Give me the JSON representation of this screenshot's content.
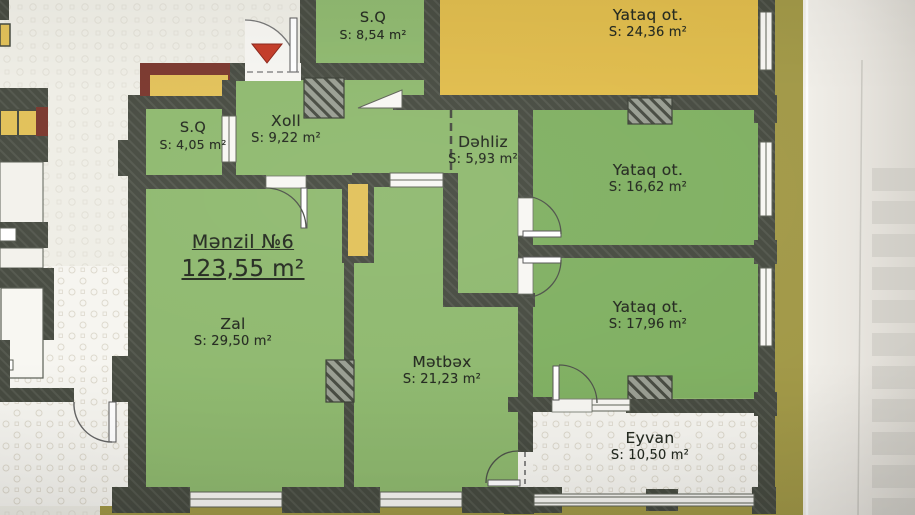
{
  "plan": {
    "apartment": {
      "label": "Mənzil №6",
      "total_area": "123,55 m²"
    },
    "rooms": {
      "sq_top": {
        "name": "S.Q",
        "area": "S: 8,54 m²"
      },
      "yataq_top": {
        "name": "Yataq ot.",
        "area": "S: 24,36 m²"
      },
      "sq_left": {
        "name": "S.Q",
        "area": "S: 4,05 m²"
      },
      "xoll": {
        "name": "Xoll",
        "area": "S: 9,22 m²"
      },
      "dehliz": {
        "name": "Dəhliz",
        "area": "S: 5,93 m²"
      },
      "yataq_mid": {
        "name": "Yataq ot.",
        "area": "S: 16,62 m²"
      },
      "zal": {
        "name": "Zal",
        "area": "S: 29,50 m²"
      },
      "metbex": {
        "name": "Mətbəx",
        "area": "S: 21,23 m²"
      },
      "yataq_bot": {
        "name": "Yataq ot.",
        "area": "S: 17,96 m²"
      },
      "eyvan": {
        "name": "Eyvan",
        "area": "S: 10,50 m²"
      }
    },
    "colors": {
      "paper": "#efeee6",
      "paper_mark": "#dedbd1",
      "green_light": "#8fb96f",
      "green_dark": "#80b062",
      "yellow_room": "#e0bc4c",
      "wall": "#474b41",
      "maroon": "#7b382e",
      "shaft_yellow": "#e2c159",
      "olive": "#a29948",
      "entry_red": "#c53b27",
      "floor_white": "#f6f5f0",
      "text": "#242a20"
    }
  }
}
